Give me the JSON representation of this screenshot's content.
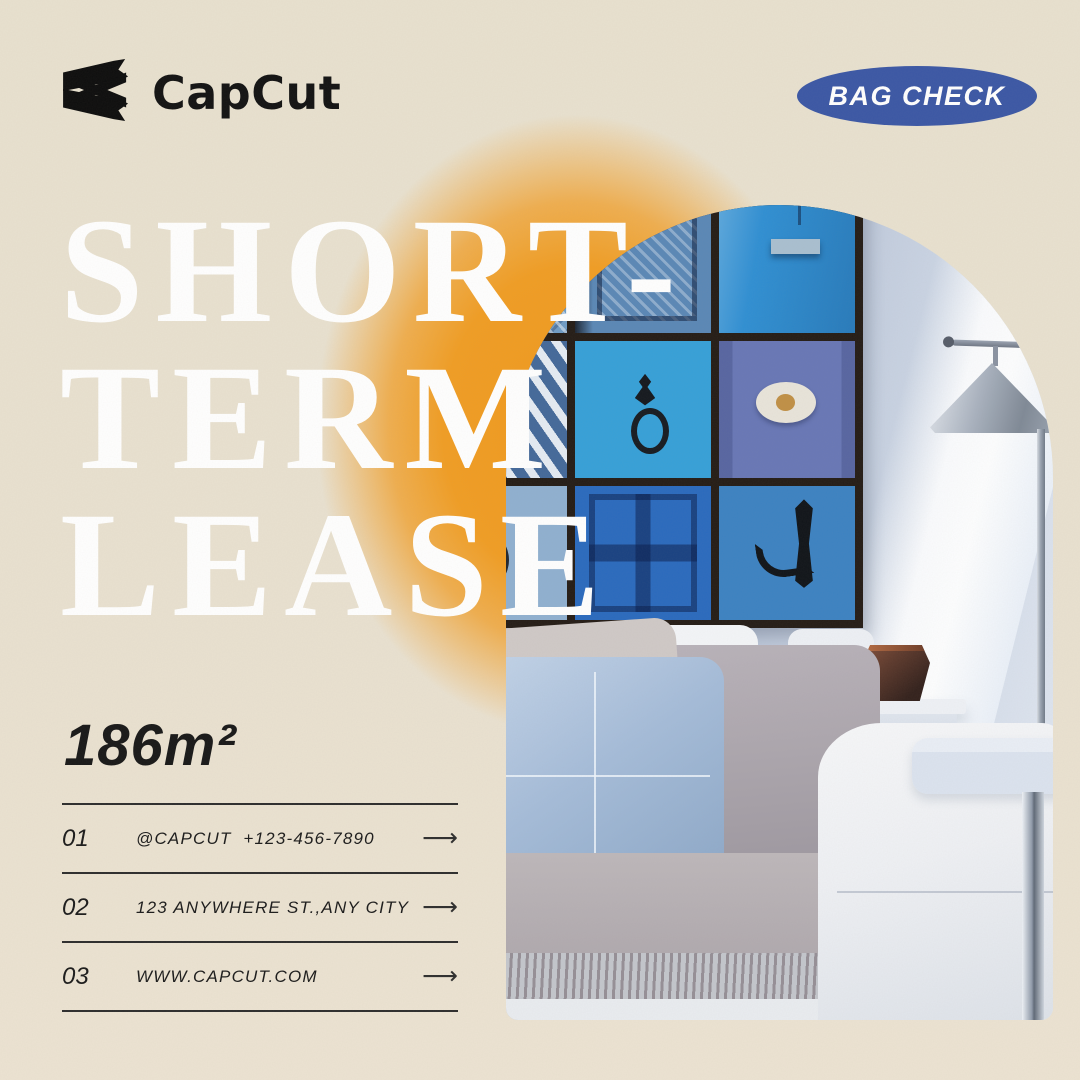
{
  "brand": {
    "wordmark": "CapCut"
  },
  "badge": {
    "label": "BAG CHECK",
    "background": "#3b57a5",
    "text_color": "#ffffff"
  },
  "title": {
    "lines": [
      "SHORT-",
      "TERM",
      "LEASE"
    ],
    "color": "#ffffff"
  },
  "area": {
    "value": "186m²"
  },
  "contact_rows": [
    {
      "index": "01",
      "text": "@CAPCUT  +123-456-7890"
    },
    {
      "index": "02",
      "text": "123 ANYWHERE ST.,ANY CITY"
    },
    {
      "index": "03",
      "text": "WWW.CAPCUT.COM"
    }
  ],
  "icons": {
    "arrow": "⟶",
    "logo": "capcut-clapper-icon"
  },
  "colors": {
    "background": "#e8e1cf",
    "glow_orange": "#f0991d",
    "badge_blue": "#3b57a5",
    "title_white": "#ffffff",
    "text_dark": "#1b1b1b"
  },
  "photo": {
    "collage_tiles": [
      {
        "variant": "lattice",
        "color": "#6f9cc6"
      },
      {
        "variant": "door-lattice",
        "color": "#5a87b6"
      },
      {
        "variant": "metal",
        "color": "#2f8fd3"
      },
      {
        "variant": "stripes",
        "color": "#7897bd"
      },
      {
        "variant": "knocker",
        "color": "#36a0d8"
      },
      {
        "variant": "plate",
        "color": "#6877b6"
      },
      {
        "variant": "ring",
        "color": "#8fb0d0"
      },
      {
        "variant": "panels",
        "color": "#2a6abe"
      },
      {
        "variant": "handle",
        "color": "#3c82c2"
      }
    ]
  }
}
